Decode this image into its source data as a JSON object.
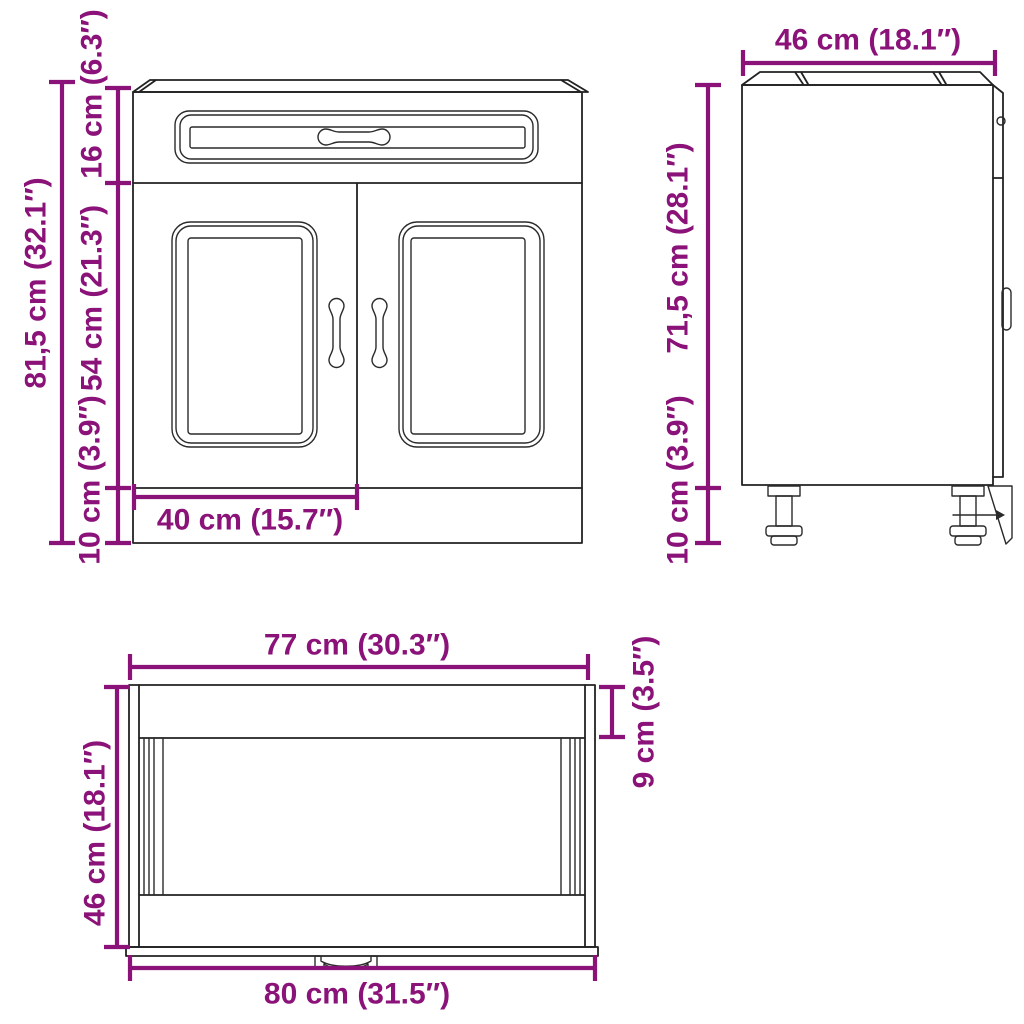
{
  "diagram_kind": "cabinet-dimension-drawing",
  "views": {
    "front": {
      "label_total_height": "81,5 cm (32.1″)",
      "label_drawer_height": "16 cm (6.3″)",
      "label_door_height": "54 cm (21.3″)",
      "label_plinth_height": "10 cm (3.9″)",
      "label_door_width": "40 cm (15.7″)"
    },
    "side": {
      "label_depth": "46 cm (18.1″)",
      "label_body_height": "71,5 cm (28.1″)",
      "label_leg_height": "10 cm (3.9″)"
    },
    "top": {
      "label_top_width": "77 cm (30.3″)",
      "label_back_rail_depth": "9 cm (3.5″)",
      "label_depth": "46 cm (18.1″)",
      "label_total_width": "80 cm (31.5″)"
    }
  },
  "colors": {
    "dimension": "#8a1278",
    "drawing_line": "#222222",
    "background": "#ffffff"
  }
}
